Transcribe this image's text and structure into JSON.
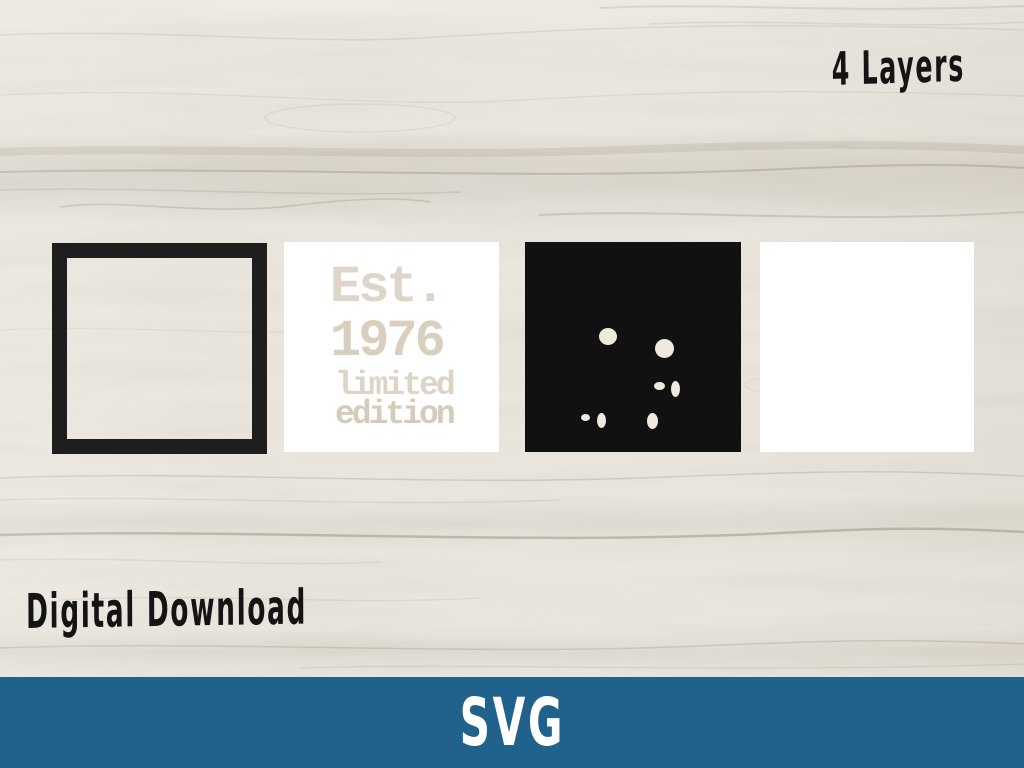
{
  "header": {
    "layers_label": "4 Layers"
  },
  "stencil": {
    "line1": "Est.",
    "line2": "1976",
    "line3": "limited",
    "line4": "edition"
  },
  "footer": {
    "digital_download_label": "Digital Download",
    "format_label": "SVG"
  },
  "colors": {
    "accent_blue": "#21628c",
    "frame_black": "#1e1e1e",
    "layer_black": "#111111",
    "square_white": "#ffffff",
    "wood_base": "#eae6de",
    "cutout_cream": "#efe9df",
    "text_black": "#141414"
  },
  "layer3_dots": [
    {
      "x": 74,
      "y": 86,
      "w": 18,
      "h": 17
    },
    {
      "x": 130,
      "y": 97,
      "w": 19,
      "h": 19
    },
    {
      "x": 129,
      "y": 140,
      "w": 11,
      "h": 8
    },
    {
      "x": 146,
      "y": 139,
      "w": 9,
      "h": 16
    },
    {
      "x": 56,
      "y": 172,
      "w": 9,
      "h": 7
    },
    {
      "x": 72,
      "y": 171,
      "w": 9,
      "h": 15
    },
    {
      "x": 122,
      "y": 171,
      "w": 11,
      "h": 16
    }
  ]
}
